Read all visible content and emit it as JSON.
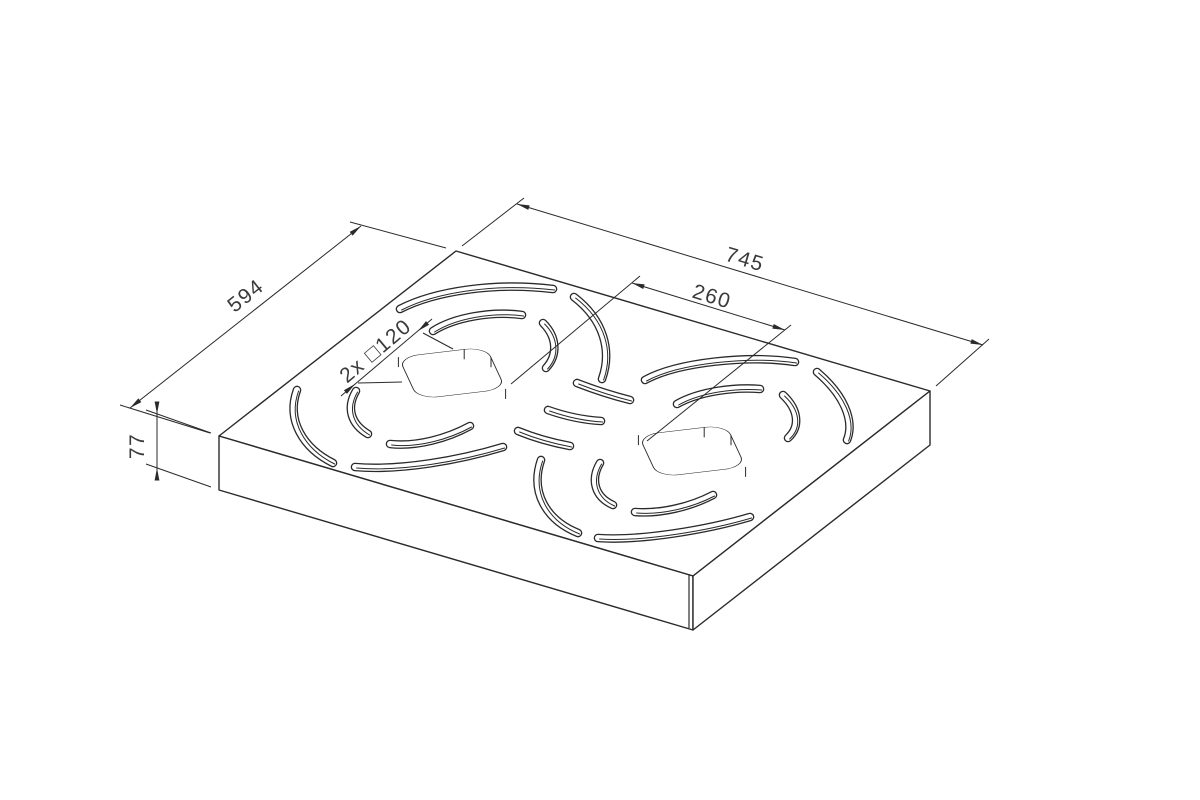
{
  "drawing": {
    "title": "isometric-grate-plate-drawing",
    "dims": {
      "length": "745",
      "width": "594",
      "thickness": "77",
      "hole_gap": "260",
      "hole_size": "2x □120"
    }
  }
}
